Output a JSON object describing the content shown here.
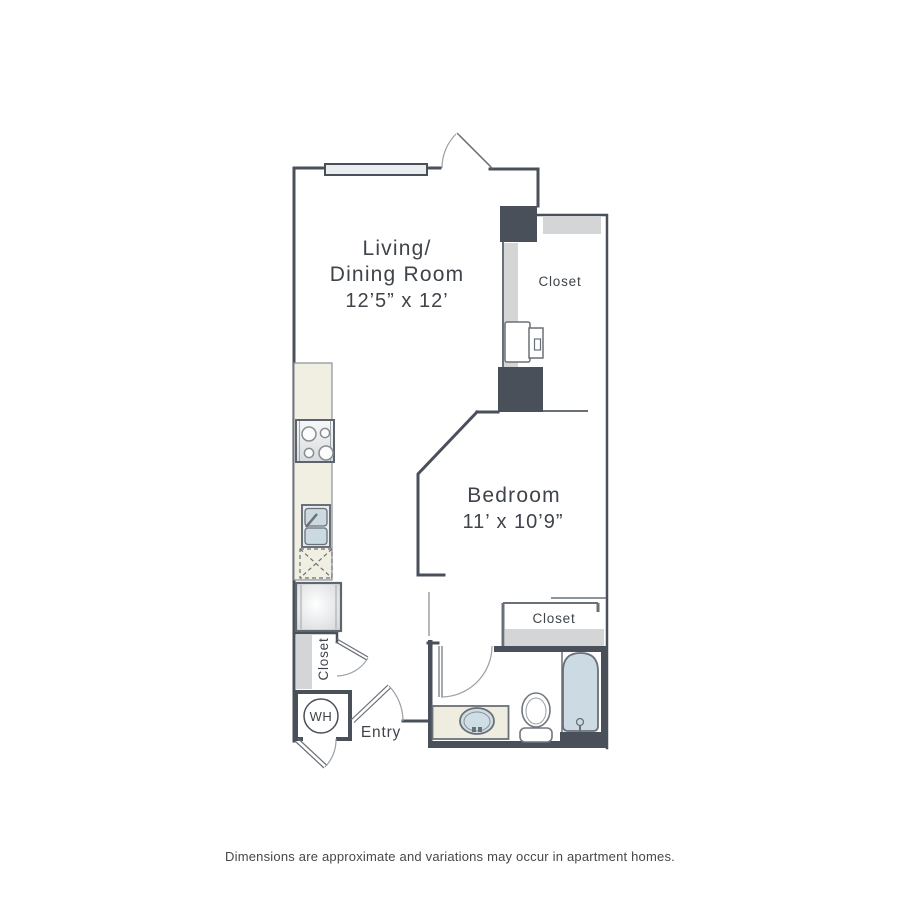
{
  "colors": {
    "wall": "#4a505a",
    "thin_line": "#6a7077",
    "shelf_gray": "#d3d5d7",
    "counter_beige": "#f0efe2",
    "fixture_blue": "#ccdbe3",
    "label_text": "#3f444a",
    "footer_text": "#474747"
  },
  "rooms": {
    "living_dining": {
      "label_line1": "Living/",
      "label_line2": "Dining Room",
      "dimensions": "12’5” x 12’"
    },
    "bedroom": {
      "label": "Bedroom",
      "dimensions": "11’ x 10’9”"
    }
  },
  "closets": {
    "entry_closet_label": "Closet",
    "hall_closet_label": "Closet",
    "bedroom_closet_label": "Closet"
  },
  "labels": {
    "entry": "Entry",
    "water_heater": "WH"
  },
  "fixtures": [
    "window",
    "balcony-door",
    "stove",
    "kitchen-sink",
    "dishwasher",
    "refrigerator",
    "washer-dryer",
    "hall-closet-door",
    "water-heater",
    "wh-door",
    "entry-door",
    "bathroom-door",
    "vanity-sink",
    "toilet",
    "bathtub"
  ],
  "footer": {
    "disclaimer": "Dimensions are approximate and variations may occur in apartment homes."
  }
}
